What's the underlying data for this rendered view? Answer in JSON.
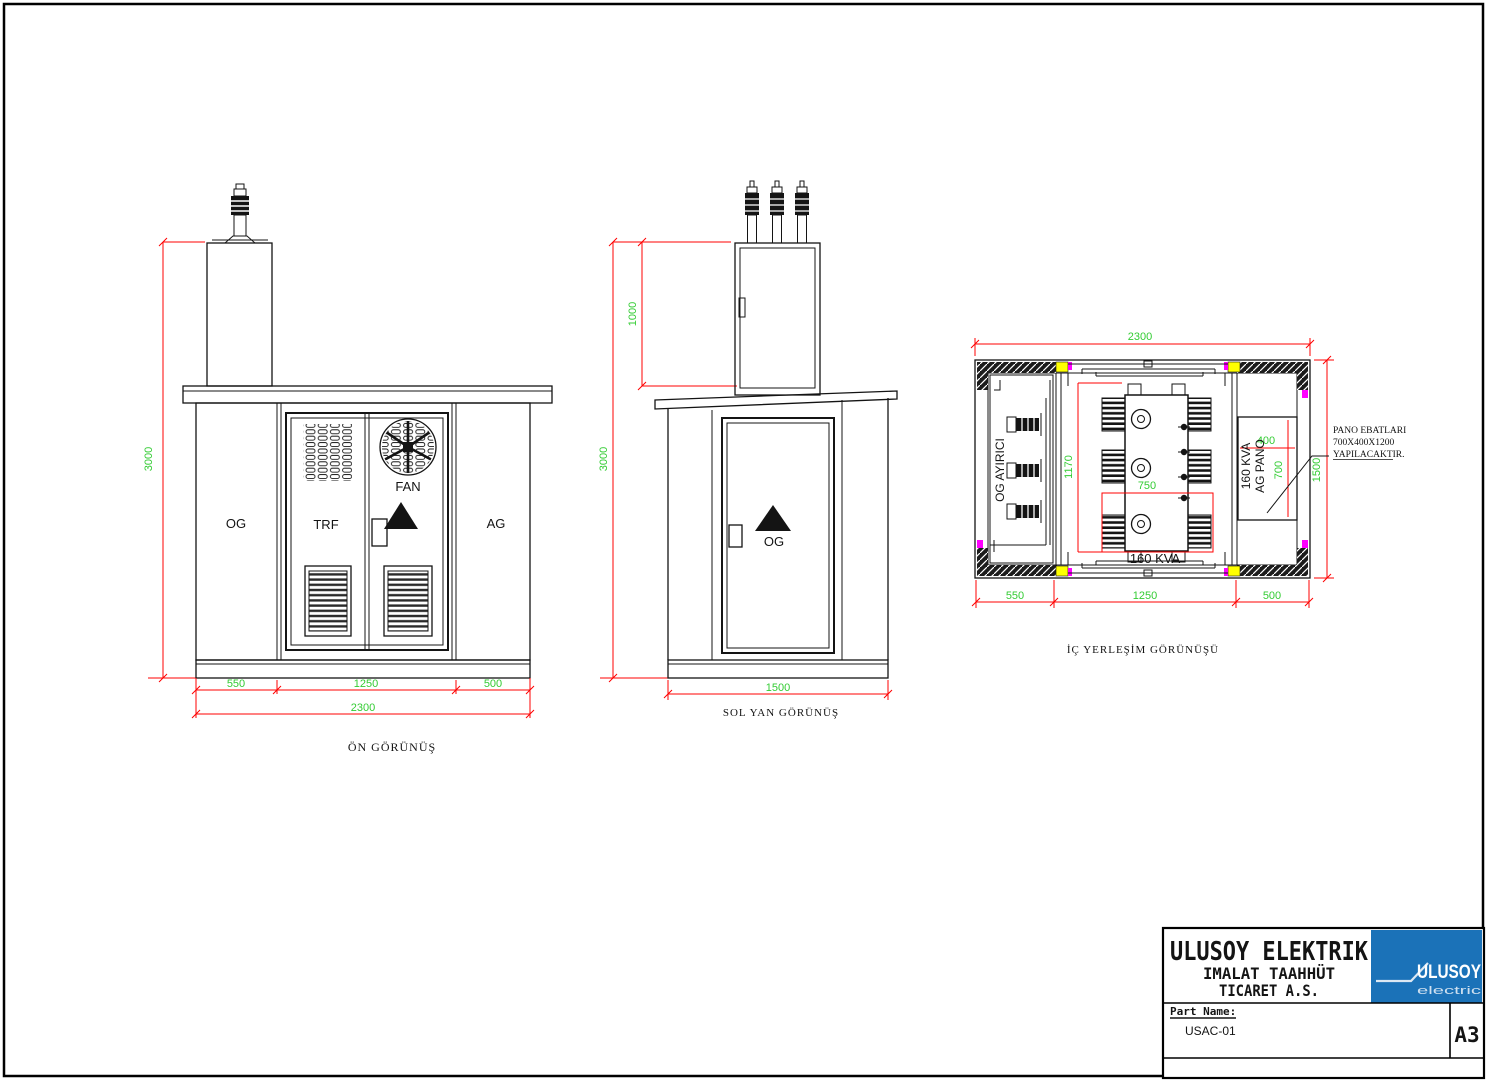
{
  "colors": {
    "line": "#141414",
    "dimension_line": "#ff0000",
    "dimension_text": "#33cc33",
    "accent_yellow": "#ffff00",
    "accent_magenta": "#ff00ff",
    "logo_blue": "#1b72b8"
  },
  "front_view": {
    "caption": "ÖN GÖRÜNÜŞ",
    "compartments": {
      "og": "OG",
      "trf": "TRF",
      "ag": "AG"
    },
    "fan_label": "FAN",
    "dims": {
      "height": "3000",
      "segments": [
        "550",
        "1250",
        "500"
      ],
      "total_width": "2300"
    }
  },
  "side_view": {
    "caption": "SOL YAN GÖRÜNÜŞ",
    "door_label": "OG",
    "dims": {
      "height": "3000",
      "og_box_height": "1000",
      "width": "1500"
    }
  },
  "plan_view": {
    "caption": "İÇ YERLEŞİM GÖRÜNÜŞÜ",
    "og_switch_label": "OG AYIRICI",
    "transformer_label": "160 KVA",
    "ag_panel_label_line1": "160 KVA",
    "ag_panel_label_line2": "AG PANO",
    "note_line1": "PANO EBATLARI",
    "note_line2": "700X400X1200",
    "note_line3": "YAPILACAKTIR.",
    "dims": {
      "total_width": "2300",
      "depth": "1500",
      "segments": [
        "550",
        "1250",
        "500"
      ],
      "transformer_length": "1170",
      "transformer_width": "750",
      "panel_width": "400",
      "panel_depth": "700"
    }
  },
  "title_block": {
    "company_line1": "ULUSOY ELEKTRIK",
    "company_line2": "IMALAT TAAHHÜT",
    "company_line3": "TICARET A.S.",
    "part_name_label": "Part Name:",
    "part_name_value": "USAC-01",
    "sheet_size": "A3",
    "logo_text": "ULUSOY",
    "logo_subtext": "electric"
  }
}
